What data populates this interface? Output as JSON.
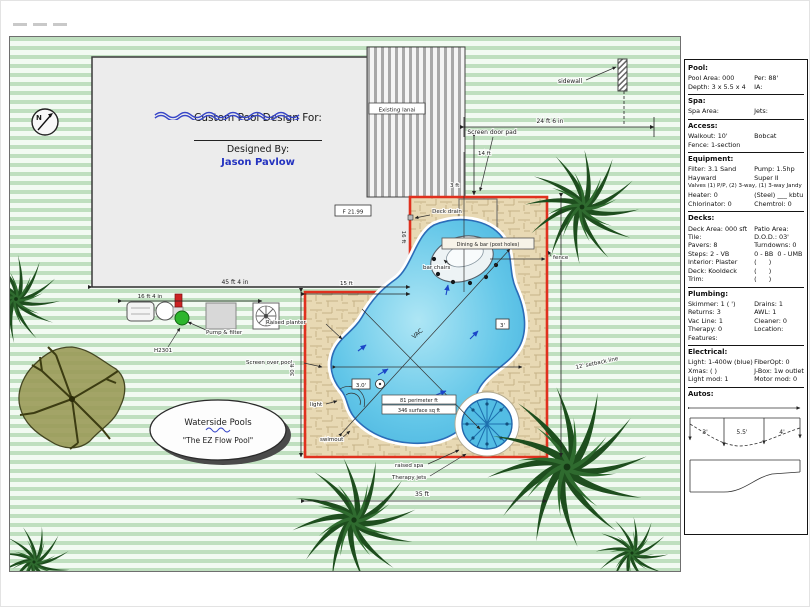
{
  "colors": {
    "enclosure_red": "#e0301e",
    "pool_water_blue": "#5cc2e6",
    "designer_blue": "#2433c0",
    "lawn_green": "#bfdfbf",
    "deck_tan": "#e8d9b4",
    "tree_green": "#1e4e1e"
  },
  "plan": {
    "north": "N",
    "design_block": {
      "title": "Custom Pool Design For:",
      "designed_by": "Designed By:",
      "designer": "Jason Pavlow"
    },
    "logo": {
      "company": "Waterside Pools",
      "tagline": "\"The EZ Flow Pool\""
    },
    "labels": {
      "existing_lanai": "Existing lanai",
      "sidewall": "sidewall",
      "screen_door_pad": "Screen door pad",
      "deck_drain": "Deck drain",
      "dining_table": "Dining & bar (post holes)",
      "bar_chairs": "bar chairs",
      "floor_elevation": "F 21.99",
      "pump_filter": "Pump & filter",
      "heater_model": "H2301",
      "screen_over_pool": "Screen over pool",
      "raised_planter": "Raised planter",
      "light": "light",
      "swimout": "swimout",
      "raised_spa": "raised spa",
      "therapy_jets": "Therapy jets",
      "fence": "fence",
      "setback_line": "12' setback line",
      "vac": "VAC",
      "shallow_marker": "3'",
      "depth_marker": "3.0'",
      "perimeter_note": "81 perimeter ft",
      "surface_note": "346 surface sq ft"
    },
    "dimensions": {
      "top_run": "24 ft 6 in",
      "door_height": "14 ft",
      "door_offset": "3 ft",
      "house_width": "45 ft 4 in",
      "house_side": "16 ft",
      "equip_run": "16 ft 4 in",
      "deck_top": "15 ft",
      "deck_left": "30 ft",
      "deck_bottom": "35 ft"
    }
  },
  "spec": {
    "s1": {
      "h": "Pool:",
      "r1l": "Pool Area: 000",
      "r1r": "Per: 88'",
      "r2l": "Depth: 3 x 5.5 x 4",
      "r2r": "IA:"
    },
    "s2": {
      "h": "Spa:",
      "r1l": "Spa Area:",
      "r1r": "Jets:"
    },
    "s3": {
      "h": "Access:",
      "r1l": "Walkout: 10'",
      "r1r": "Bobcat",
      "r2l": "Fence: 1-section",
      "r2r": ""
    },
    "s4": {
      "h": "Equipment:",
      "r1l": "Filter: 3.1 Sand",
      "r1r": "Pump: 1.5hp",
      "r2l": "Hayward",
      "r2r": "Super II",
      "full": "Valves (1) P/P, (2) 3-way, (1) 3-way Jandy",
      "r3l": "Heater: 0",
      "r3r": "(Steel) ___ kbtu",
      "r4l": "Chlorinator: 0",
      "r4r": "Chemtrol: 0"
    },
    "s5": {
      "h": "Decks:",
      "r1l": "Deck Area: 000 sft",
      "r1r": "Patio Area:",
      "r2l": "Tile:",
      "r2r": "D.O.D.: 03'",
      "r3l": "Pavers: 8",
      "r3r": "Turndowns: 0",
      "r4l": "Steps: 2 - VB",
      "r4r": "0 - BB  0 - UMB",
      "r5l": "Interior: Plaster",
      "r5r": "(      )",
      "r6l": "Deck: Kooldeck",
      "r6r": "(      )",
      "r7l": "Trim:",
      "r7r": "(      )"
    },
    "s6": {
      "h": "Plumbing:",
      "r1l": "Skimmer: 1 ( ')",
      "r1r": "Drains: 1",
      "r2l": "Returns: 3",
      "r2r": "AWL: 1",
      "r3l": "Vac Line: 1",
      "r3r": "Cleaner: 0",
      "r4l": "Therapy: 0",
      "r4r": "Location:",
      "r5l": "Features:",
      "r5r": ""
    },
    "s7": {
      "h": "Electrical:",
      "r1l": "Light: 1-400w (blue)",
      "r1r": "FiberOpt: 0",
      "r2l": "Xmas: ( )",
      "r2r": "J-Box: 1w outlet",
      "r3l": "Light mod: 1",
      "r3r": "Motor mod: 0"
    },
    "s8": {
      "h": "Autos:"
    },
    "profile": {
      "shallow": "3'",
      "deep": "5.5'",
      "end": "4'"
    }
  }
}
